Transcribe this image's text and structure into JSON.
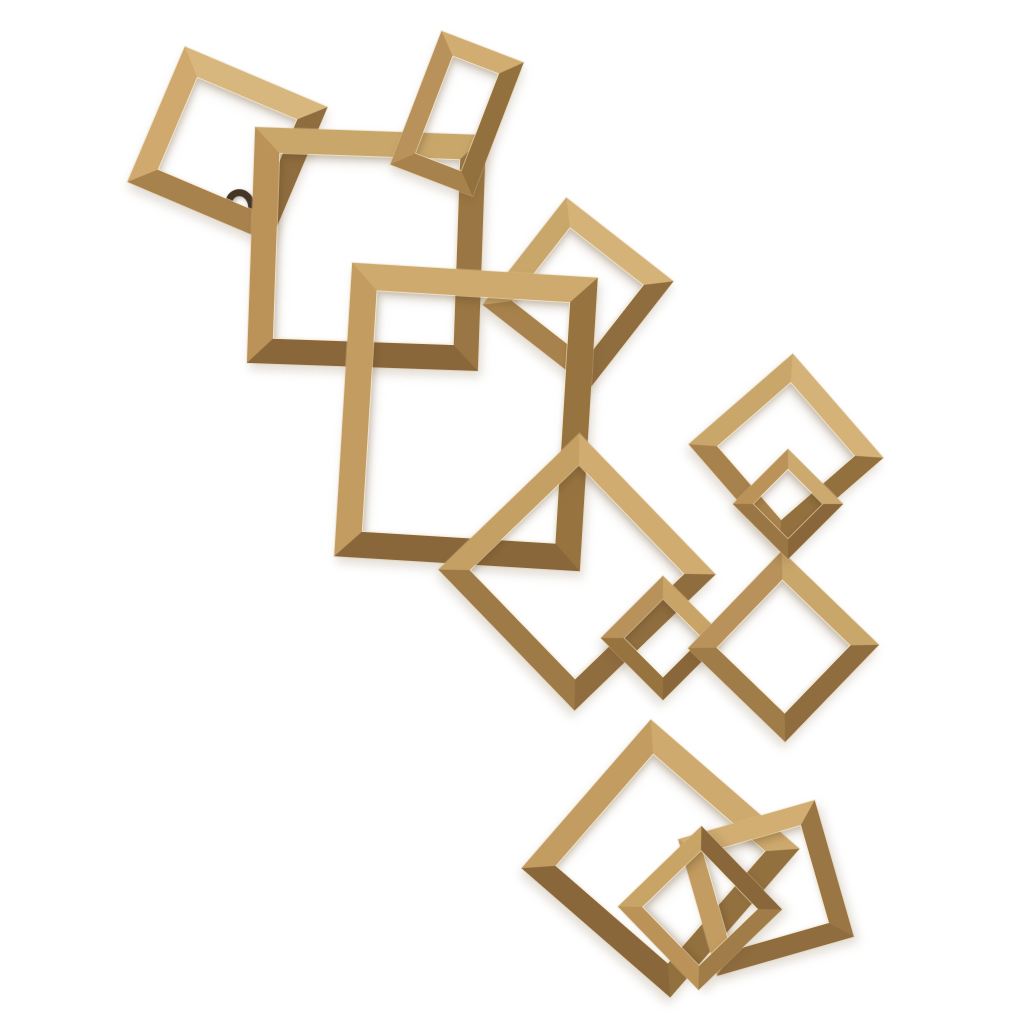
{
  "meta": {
    "description": "Product photograph of an antique gold interlocking-squares metal wall sculpture on a plain white background",
    "background_color": "#ffffff"
  },
  "artwork": {
    "name": "interlocking-gold-squares-wall-decor",
    "canvas": {
      "width": 1024,
      "height": 1024
    },
    "material_colors": {
      "highlight": "#e6d2a2",
      "light": "#d6b57c",
      "mid": "#b8925a",
      "dark": "#8a673a",
      "deep_shadow": "#6e5230"
    },
    "hook": {
      "cx": 240,
      "cy": 206,
      "w": 30,
      "h": 34,
      "ring": 7,
      "color": "#443527"
    },
    "squares": [
      {
        "id": "square-top-left",
        "cx": 227,
        "cy": 144,
        "w": 155,
        "h": 147,
        "rot": 23,
        "border": 23,
        "colors": {
          "top": "#d8b77e",
          "right": "#8f6d3f",
          "bottom": "#a8824c",
          "left": "#cfa96d"
        }
      },
      {
        "id": "square-upper-large",
        "cx": 366,
        "cy": 249,
        "w": 231,
        "h": 236,
        "rot": 2,
        "border": 25,
        "colors": {
          "top": "#c9a76b",
          "right": "#9a7644",
          "bottom": "#8a673a",
          "left": "#bb9257"
        }
      },
      {
        "id": "rect-top-small",
        "cx": 457,
        "cy": 113,
        "w": 88,
        "h": 143,
        "rot": 21,
        "border": 19,
        "colors": {
          "top": "#d2ad72",
          "right": "#93713f",
          "bottom": "#a8824c",
          "left": "#b8925a"
        }
      },
      {
        "id": "diamond-upper-mid",
        "cx": 578,
        "cy": 293,
        "w": 136,
        "h": 136,
        "rot": 38,
        "border": 21,
        "colors": {
          "top": "#d4b278",
          "right": "#8f6d3f",
          "bottom": "#a8824c",
          "left": "#c9a76b"
        }
      },
      {
        "id": "rect-center-large",
        "cx": 466,
        "cy": 417,
        "w": 246,
        "h": 294,
        "rot": 3.5,
        "border": 26,
        "colors": {
          "top": "#ceaa6e",
          "right": "#96733f",
          "bottom": "#8a673a",
          "left": "#c29c60"
        }
      },
      {
        "id": "diamond-center",
        "cx": 577,
        "cy": 572,
        "w": 196,
        "h": 196,
        "rot": 46,
        "border": 22,
        "colors": {
          "top": "#d0ac70",
          "right": "#8f6d3f",
          "bottom": "#9d7a46",
          "left": "#c4a065"
        }
      },
      {
        "id": "diamond-mid-small",
        "cx": 663,
        "cy": 638,
        "w": 88,
        "h": 88,
        "rot": 45,
        "border": 16,
        "colors": {
          "top": "#c9a467",
          "right": "#8a673a",
          "bottom": "#97743f",
          "left": "#b8925a"
        }
      },
      {
        "id": "diamond-right-lower",
        "cx": 783,
        "cy": 646,
        "w": 135,
        "h": 135,
        "rot": 44,
        "border": 20,
        "colors": {
          "top": "#c9a76b",
          "right": "#8f6d3f",
          "bottom": "#a07c48",
          "left": "#b8925a"
        }
      },
      {
        "id": "diamond-right-upper",
        "cx": 786,
        "cy": 451,
        "w": 138,
        "h": 138,
        "rot": 49,
        "border": 20,
        "colors": {
          "top": "#d4b278",
          "right": "#93713f",
          "bottom": "#a8824c",
          "left": "#c9a76b"
        }
      },
      {
        "id": "square-right-link",
        "cx": 788,
        "cy": 504,
        "w": 78,
        "h": 78,
        "rot": 45,
        "border": 14,
        "colors": {
          "top": "#cba96f",
          "right": "#8a673a",
          "bottom": "#9a7644",
          "left": "#bb9257"
        }
      },
      {
        "id": "square-bottom-large",
        "cx": 660,
        "cy": 858,
        "w": 197,
        "h": 197,
        "rot": 41,
        "border": 24,
        "colors": {
          "top": "#ceaa6e",
          "right": "#93713f",
          "bottom": "#8a673a",
          "left": "#c29c60"
        }
      },
      {
        "id": "square-bottom-right",
        "cx": 766,
        "cy": 888,
        "w": 142,
        "h": 142,
        "rot": -16,
        "border": 20,
        "colors": {
          "top": "#d2ae73",
          "right": "#9a7644",
          "bottom": "#8f6d3f",
          "left": "#c29c60"
        }
      },
      {
        "id": "diamond-bottom-small",
        "cx": 700,
        "cy": 908,
        "w": 116,
        "h": 116,
        "rot": -44,
        "border": 17,
        "colors": {
          "top": "#c9a467",
          "right": "#8a673a",
          "bottom": "#a07c48",
          "left": "#bb9257"
        }
      }
    ]
  }
}
